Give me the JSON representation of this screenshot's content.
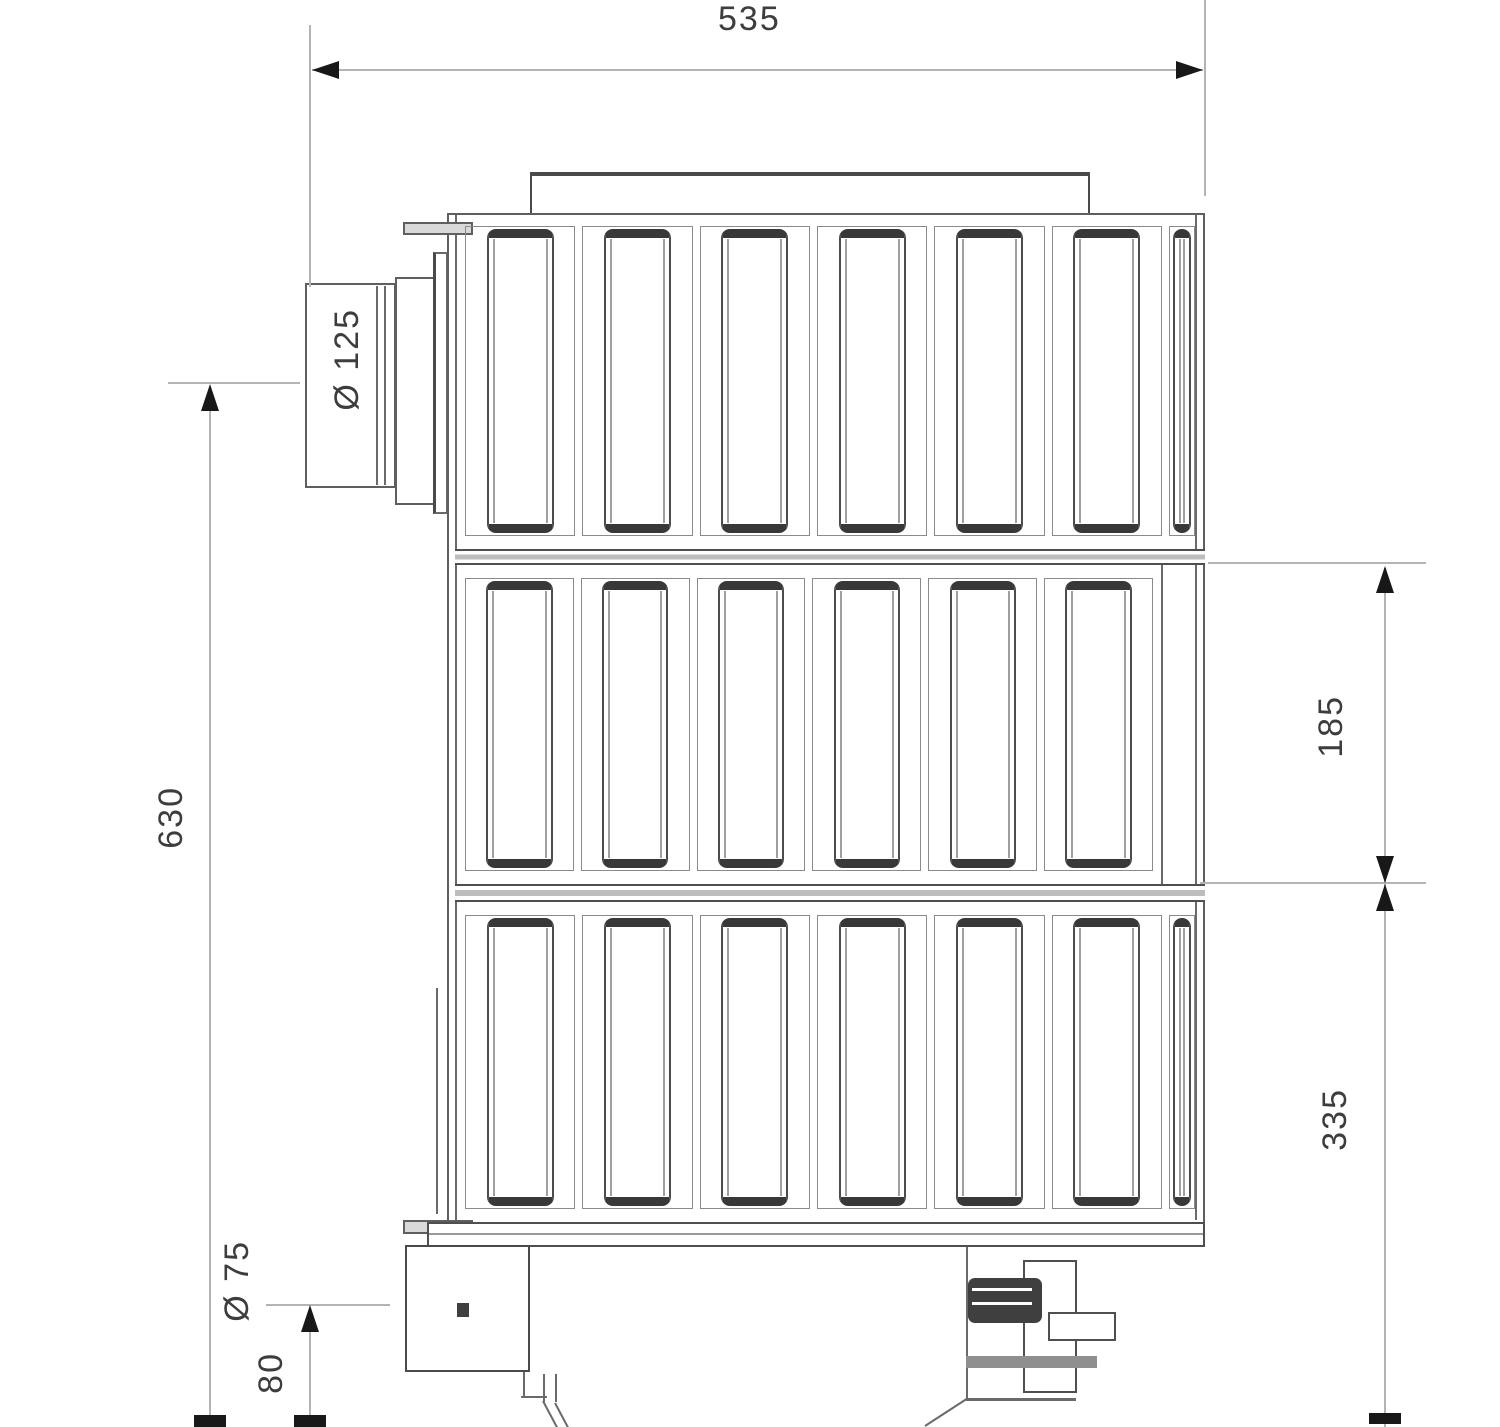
{
  "drawing": {
    "type": "technical-dimension-drawing",
    "labels": {
      "top_width": "535",
      "overall_height": "630",
      "module_height": "185",
      "lower_section_height": "335",
      "flue_diameter": "Ø 125",
      "drain_diameter": "Ø 75",
      "drain_center_height": "80"
    },
    "grid": {
      "rows": [
        {
          "wide_slots": 6,
          "narrow_slots": 1
        },
        {
          "wide_slots": 6,
          "narrow_slots": 0
        },
        {
          "wide_slots": 6,
          "narrow_slots": 1
        }
      ]
    },
    "colors": {
      "background": "#ffffff",
      "structure_line": "#5f5f5f",
      "structure_dark": "#3a3a3a",
      "dimension_line": "#b4b4b4",
      "arrow": "#1a1a1a",
      "text": "#3d3d3d"
    }
  }
}
